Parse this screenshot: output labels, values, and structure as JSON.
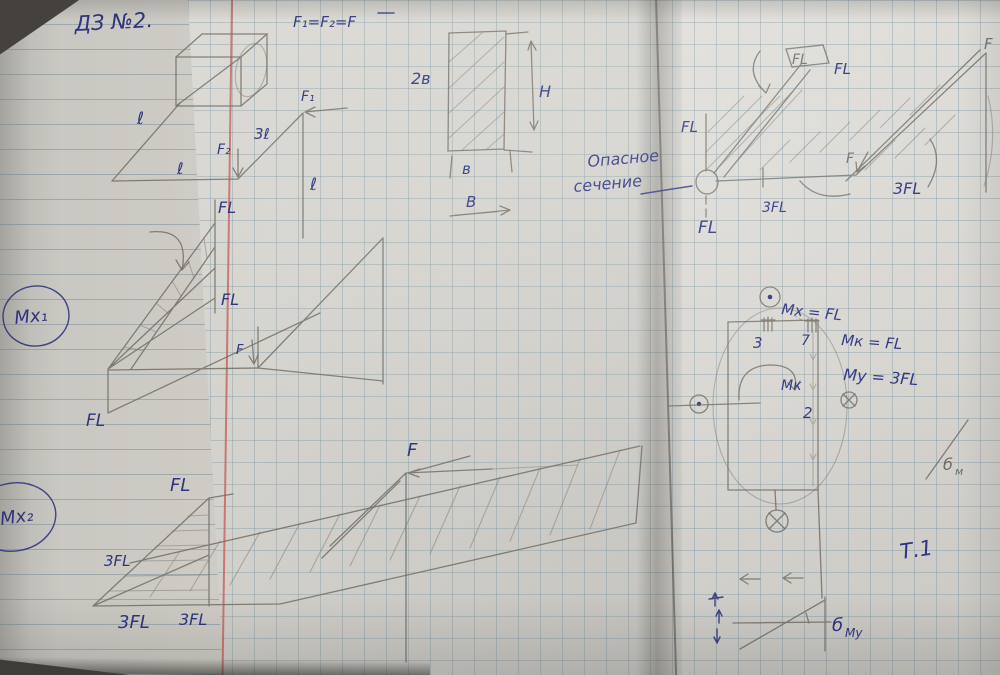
{
  "colors": {
    "ink": "#2e3480",
    "pencil": "#716f67",
    "paper": "#d4d2cc",
    "red_margin": "#c6605a",
    "grid": "#7a94a0"
  },
  "left": {
    "title": "ДЗ №2.",
    "formula": "F₁=F₂=F",
    "beam": {
      "len_diag": "ℓ",
      "len_horiz": "ℓ",
      "force2": "F₂",
      "len_3l": "3ℓ",
      "force1": "F₁",
      "len_vert": "ℓ"
    },
    "mx1": {
      "badge": "Мх₁",
      "fl_top": "FL",
      "fl_mid": "FL",
      "force": "F",
      "fl_bottom": "FL"
    },
    "mx2": {
      "badge": "Мх₂",
      "fl_peak": "FL",
      "fl3_left": "3FL",
      "fl3_bottom1": "3FL",
      "fl3_bottom2": "3FL",
      "force": "F"
    },
    "section": {
      "w_top": "2в",
      "h": "Н",
      "w_b": "в",
      "w_cap": "В"
    }
  },
  "right": {
    "note1": "Опасное",
    "note2": "сечение",
    "beam": {
      "fl_flag": "FL",
      "fl_flag2": "FL",
      "fl_left": "FL",
      "fl_below": "FL",
      "fl3_mid": "3FL",
      "force_mid": "F",
      "fl3_right": "3FL",
      "force_corner": "F"
    },
    "section": {
      "mx": "Мх = FL",
      "mk": "Мк = FL",
      "my": "Му = 3FL",
      "p3": "3",
      "p7": "7",
      "p2": "2",
      "mk_small": "Мк"
    },
    "sigma_my_base": "б",
    "sigma_my_sub": "Му",
    "sigma_right_base": "б",
    "sigma_right_sub": "м",
    "t1": "Т.1"
  }
}
